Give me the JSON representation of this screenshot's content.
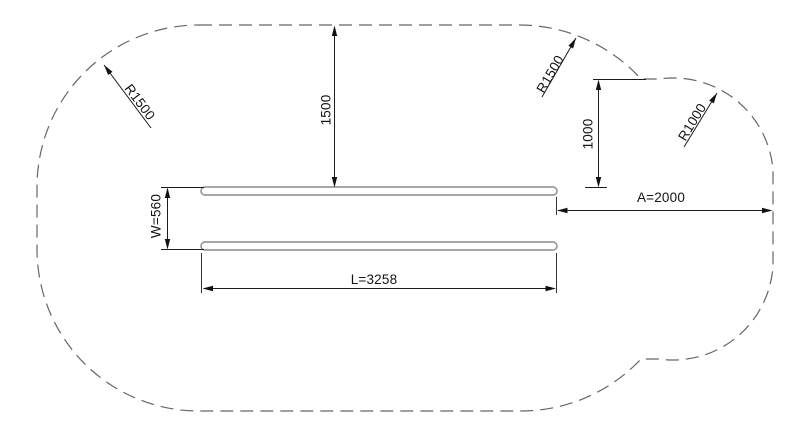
{
  "drawing": {
    "labels": {
      "radius_top_left": "R1500",
      "vertical_clearance": "1500",
      "radius_top_right": "R1500",
      "step_clearance": "1000",
      "radius_right": "R1000",
      "side_clearance": "A=2000",
      "equipment_width": "W=560",
      "equipment_length": "L=3258"
    },
    "colors": {
      "background": "#ffffff",
      "boundary_line": "#666666",
      "dimension_line": "#1c1c1c",
      "equipment_line": "#9a9a9a",
      "text": "#141414"
    }
  }
}
